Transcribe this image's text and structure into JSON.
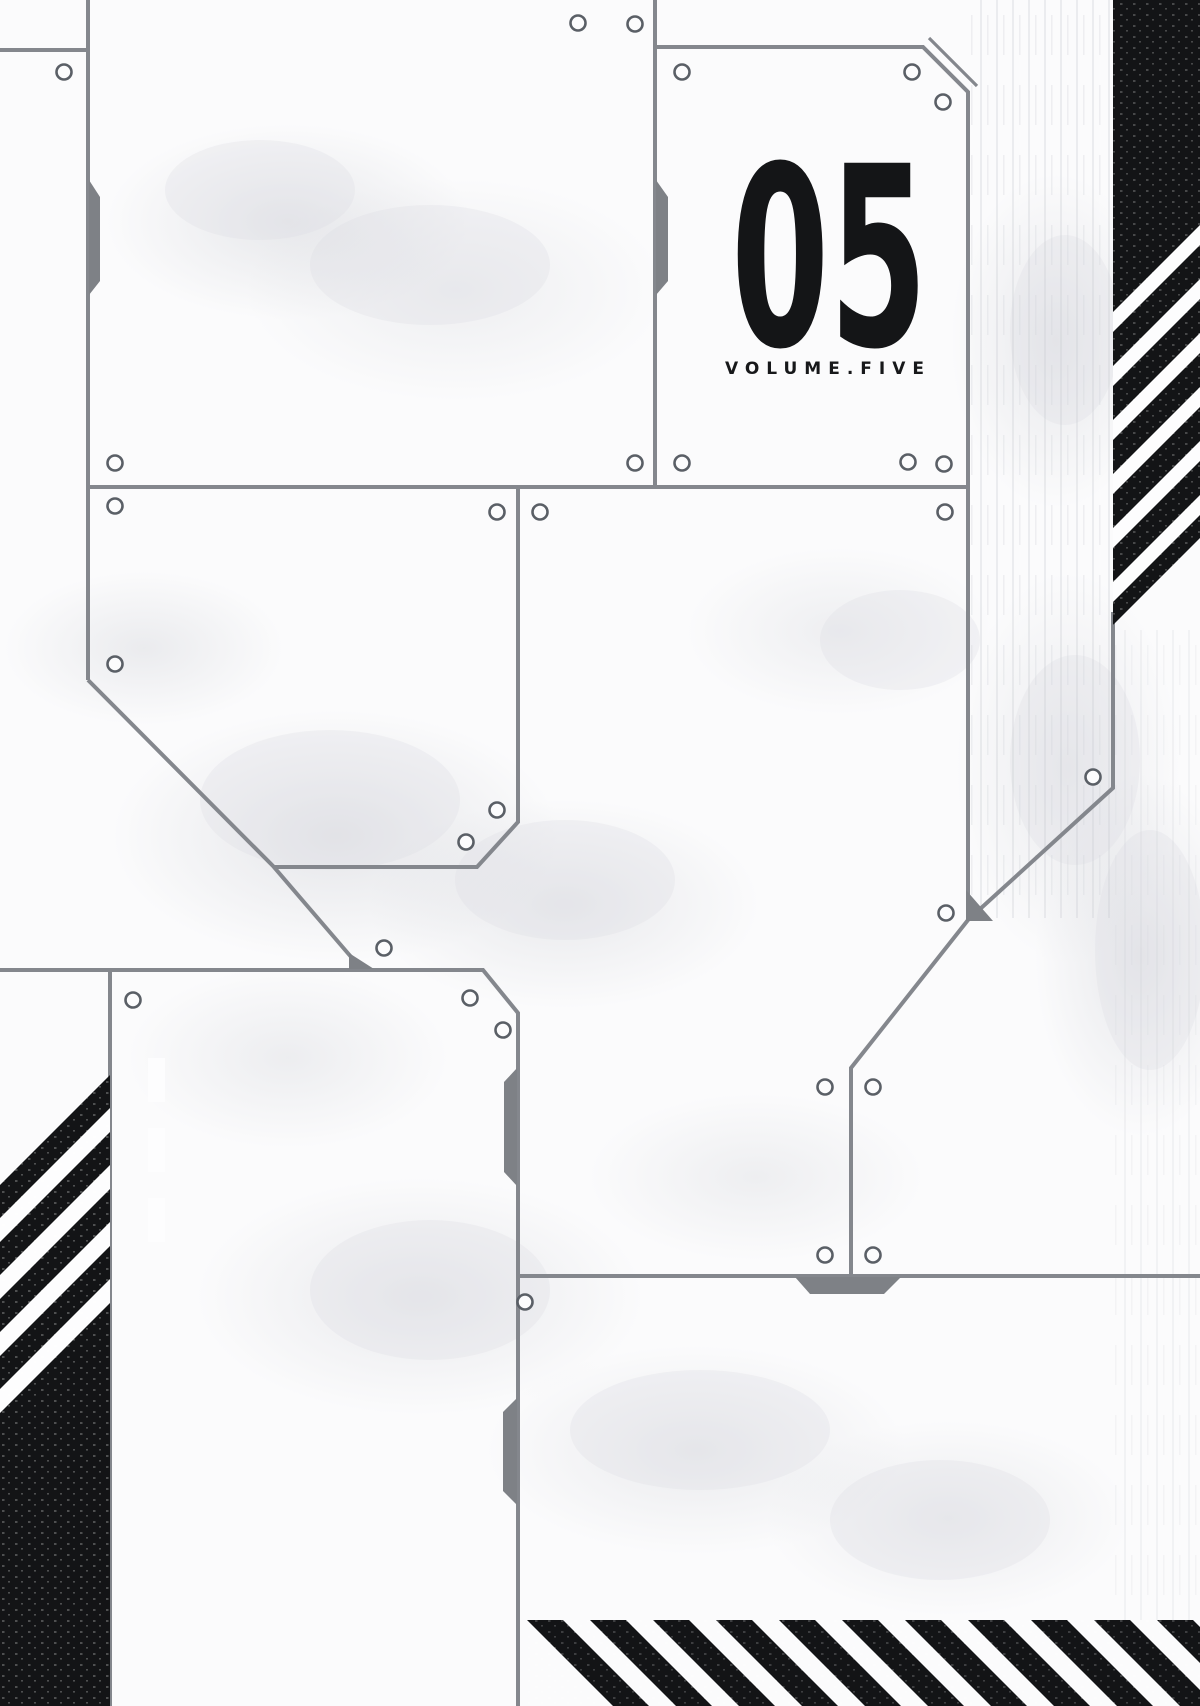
{
  "cover": {
    "volume_number": "05",
    "volume_label": "VOLUME.FIVE",
    "colors": {
      "paper": "#fbfbfc",
      "panel_line_gray": "#84878d",
      "tab_gray": "#7e8186",
      "ink_black": "#131416",
      "texture_gray": "#d9dbe0"
    },
    "icons": {
      "rivet": "outlined circle screw hole",
      "vent_slot": "outlined vertical slot",
      "hazard_stripes": "45-degree black and white warning stripes"
    }
  }
}
